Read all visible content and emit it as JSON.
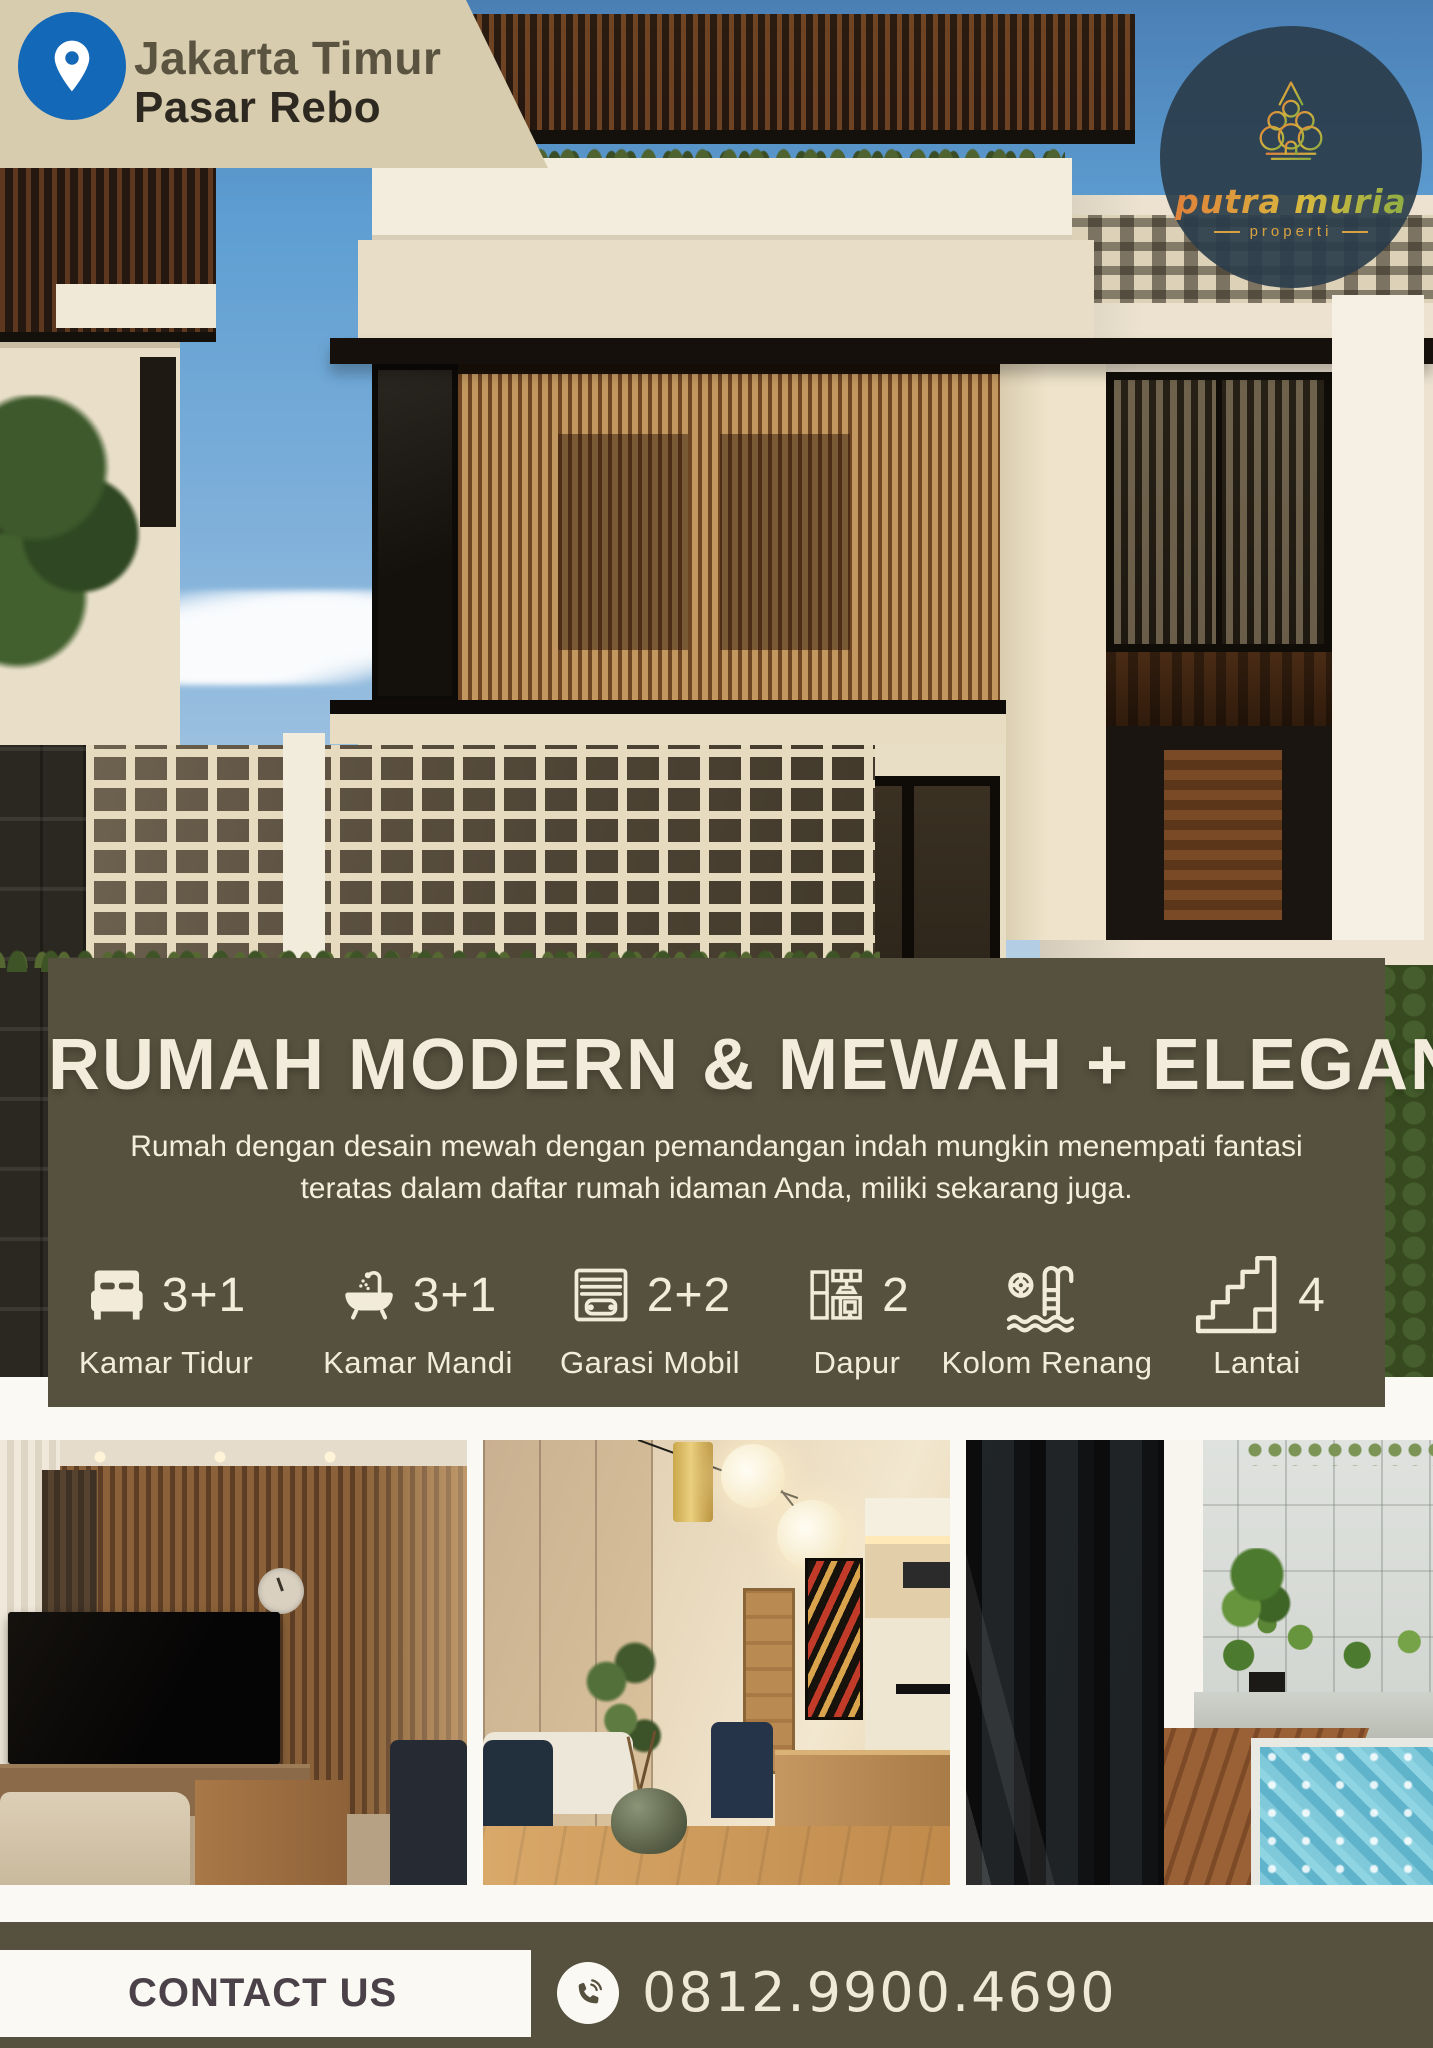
{
  "location_badge": {
    "line1": "Jakarta Timur",
    "line2": "Pasar Rebo"
  },
  "logo": {
    "name": "putra muria",
    "subtitle": "properti"
  },
  "headline": {
    "title": "RUMAH MODERN & MEWAH + ELEGAN",
    "description": "Rumah dengan desain mewah dengan pemandangan indah mungkin menempati fantasi teratas dalam daftar rumah idaman Anda, miliki sekarang juga."
  },
  "features": [
    {
      "icon": "bed-icon",
      "value": "3+1",
      "label": "Kamar Tidur"
    },
    {
      "icon": "bathtub-icon",
      "value": "3+1",
      "label": "Kamar Mandi"
    },
    {
      "icon": "garage-icon",
      "value": "2+2",
      "label": "Garasi Mobil"
    },
    {
      "icon": "kitchen-icon",
      "value": "2",
      "label": "Dapur"
    },
    {
      "icon": "pool-ladder-icon",
      "value": "",
      "label": "Kolom Renang"
    },
    {
      "icon": "stairs-icon",
      "value": "4",
      "label": "Lantai"
    }
  ],
  "contact": {
    "button_label": "CONTACT US",
    "phone_number": "0812.9900.4690"
  },
  "colors": {
    "panel_olive": "#56503E",
    "cream_text": "#F2EBDA",
    "badge_beige": "#D8CCAF",
    "pin_blue": "#1468B8",
    "contact_text": "#4B4149"
  }
}
